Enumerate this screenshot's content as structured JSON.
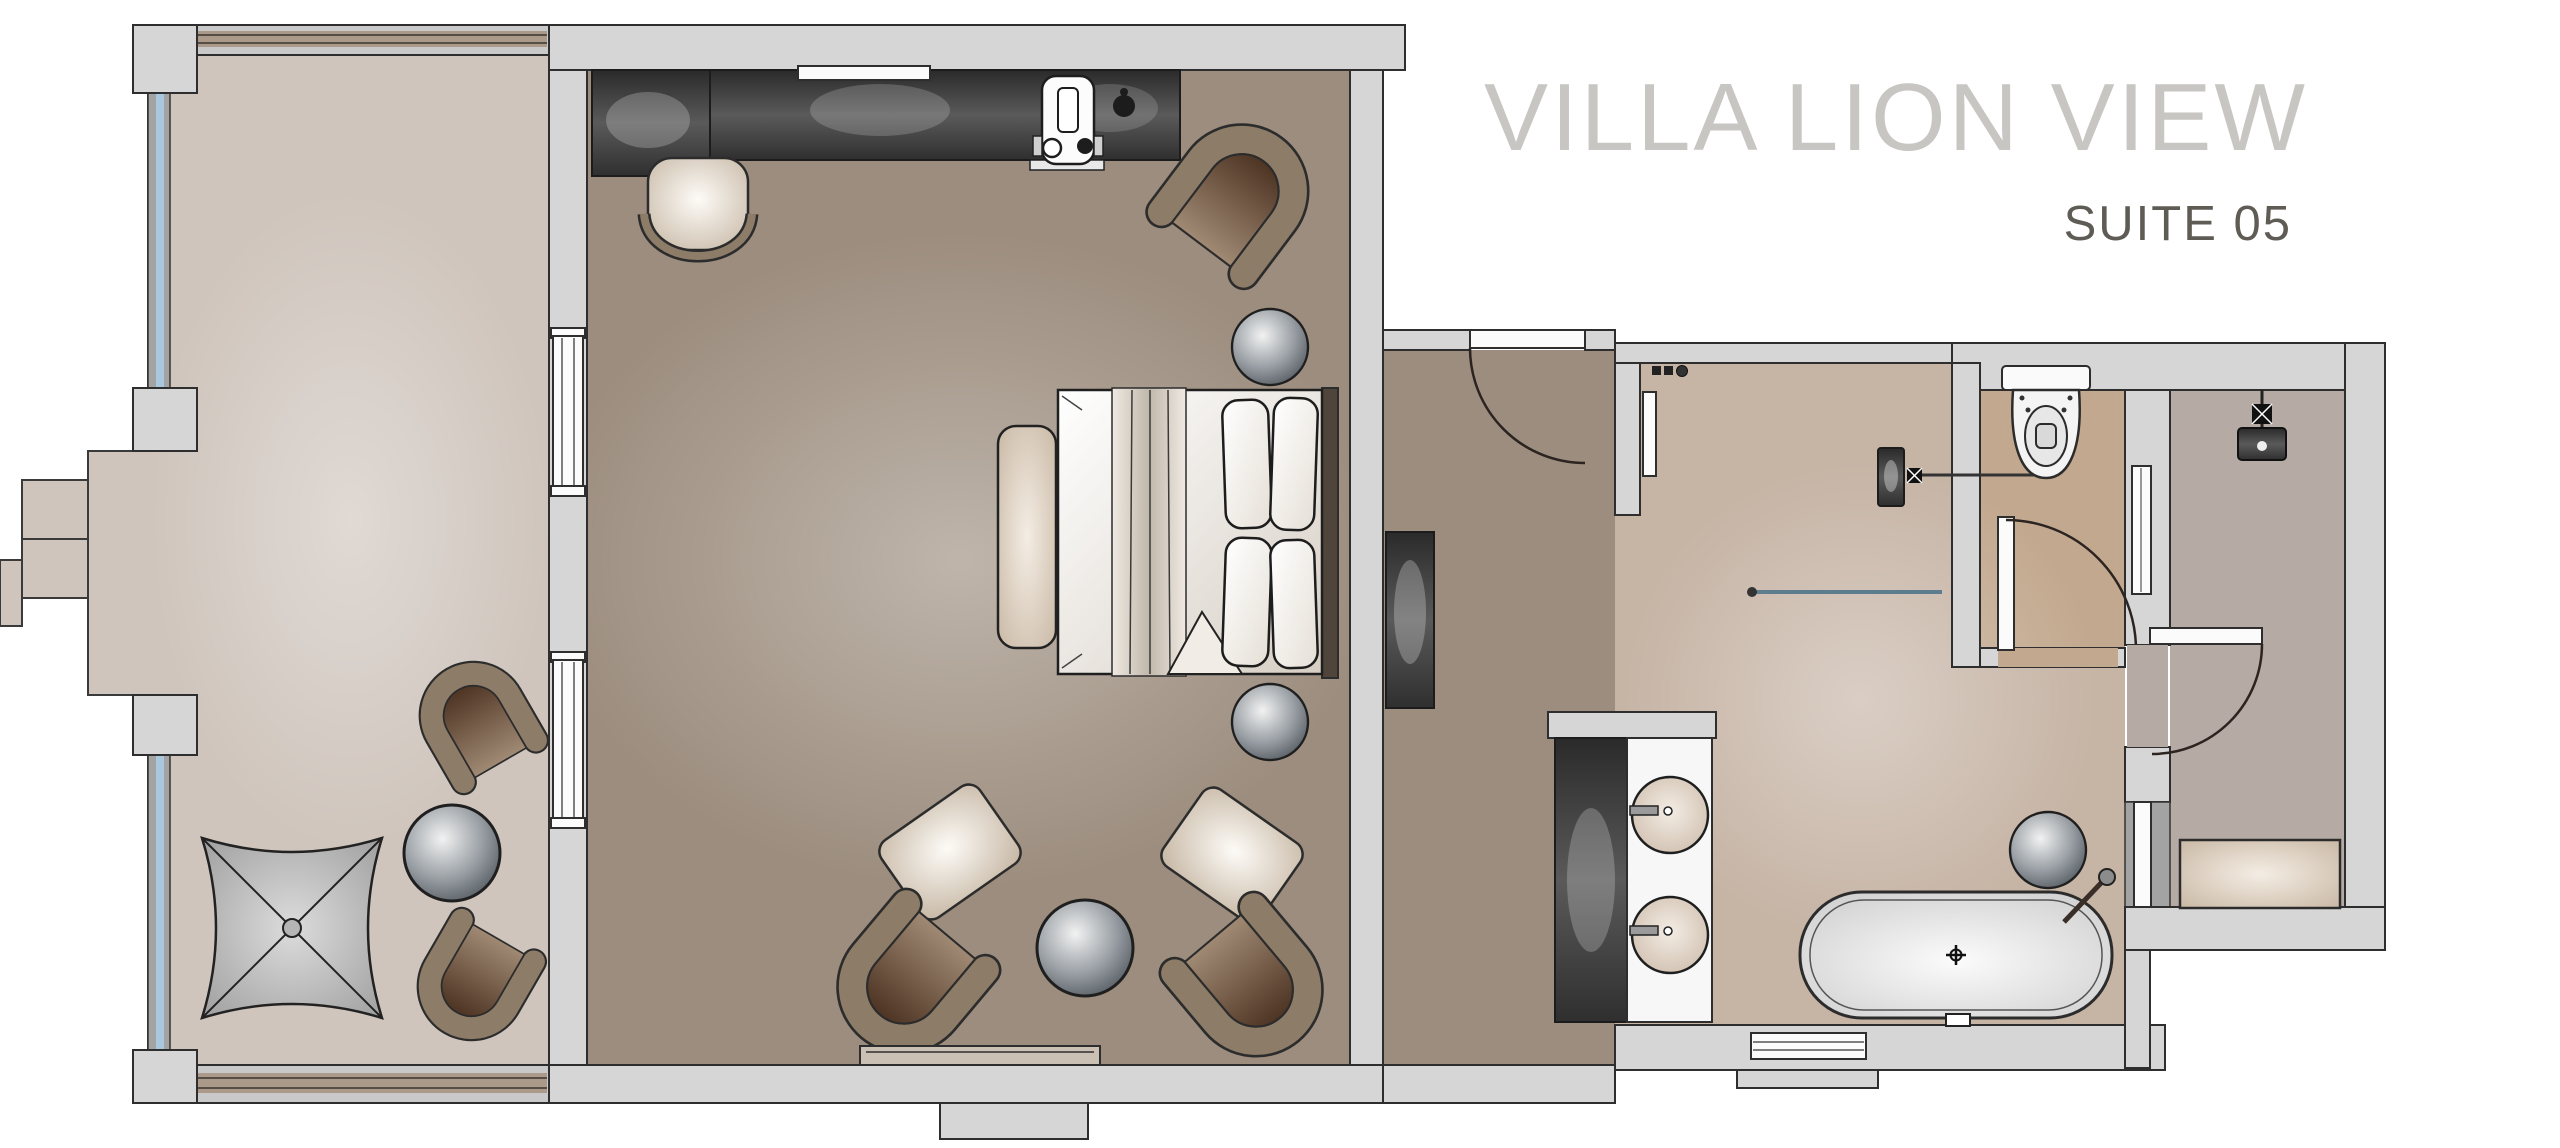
{
  "header": {
    "title": "VILLA LION VIEW",
    "subtitle": "SUITE 05"
  },
  "palette": {
    "wall_fill": "#d6d6d6",
    "wall_stroke": "#2e2e2e",
    "terrace_floor": "#cfc5bd",
    "bedroom_floor": "#9c8d7e",
    "hall_floor": "#9c8d7e",
    "bathroom_floor": "#c6b4a5",
    "wc_floor": "#c2a88e",
    "shower_floor": "#b6aaa4",
    "glass_blue": "#a9c7dd",
    "glass_frame": "#a3a3a3",
    "band_tan": "#ab9a89",
    "chair_ring": "#8d7c68",
    "dark_furniture": "#3c3c3c",
    "title_color": "#c8c6c3",
    "subtitle_color": "#5f5c55"
  },
  "plan": {
    "type": "hotel-suite-floor-plan",
    "rooms": [
      {
        "id": "terrace",
        "furniture": [
          "parasol",
          "lounge-chair",
          "lounge-chair",
          "sphere-side-table",
          "garden-steps"
        ]
      },
      {
        "id": "bedroom",
        "furniture": [
          "desk",
          "wardrobe-counter",
          "wall-shelf",
          "espresso-machine",
          "desk-chair",
          "armchair",
          "double-bed",
          "bed-bench",
          "sphere-lamp",
          "sphere-lamp",
          "armchair",
          "armchair",
          "ottoman",
          "ottoman",
          "sphere-side-table",
          "hearth-ledge"
        ]
      },
      {
        "id": "entry-hall",
        "furniture": [
          "entry-door",
          "tv-panel",
          "towel-rail",
          "wardrobe-back"
        ]
      },
      {
        "id": "bathroom",
        "furniture": [
          "vanity-counter",
          "washbasin",
          "washbasin",
          "bathtub",
          "tub-filler",
          "sphere-stool",
          "glass-screen",
          "wall-accessories",
          "window"
        ]
      },
      {
        "id": "wc",
        "furniture": [
          "toilet",
          "wc-door"
        ]
      },
      {
        "id": "shower-room",
        "furniture": [
          "rain-shower-head",
          "shower-bench",
          "shower-door",
          "glass-panel"
        ]
      }
    ]
  }
}
